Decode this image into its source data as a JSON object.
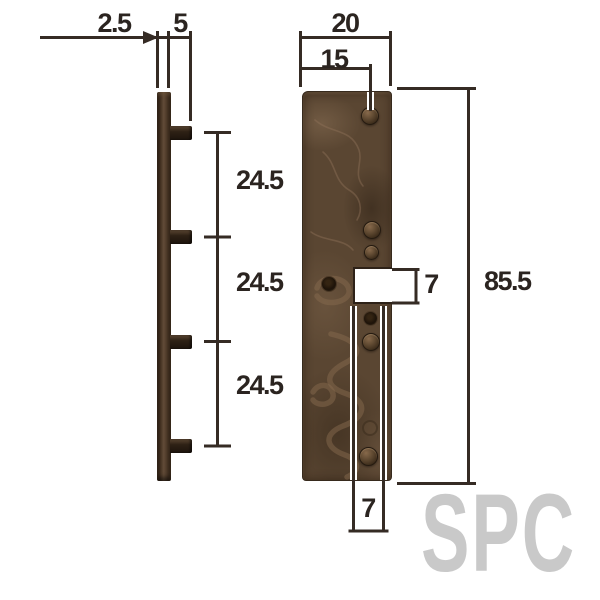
{
  "diagram": {
    "title_hint": "strike-plate dimension drawing",
    "watermark": "SPC",
    "side_view": {
      "thickness_label": "2.5",
      "peg_length_label": "5",
      "spacing_labels": [
        "24.5",
        "24.5",
        "24.5"
      ]
    },
    "front_view": {
      "width_label": "20",
      "pin_offset_label": "15",
      "height_label": "85.5",
      "notch_height_label": "7",
      "notch_width_label": "7"
    },
    "colors": {
      "plate_brown": "#5a4632",
      "side_plate_brown": "#3c2b1d",
      "dimension_line": "#352b24",
      "text": "#2b2420",
      "watermark_gray": "#c9c9c9",
      "background": "#ffffff"
    }
  }
}
